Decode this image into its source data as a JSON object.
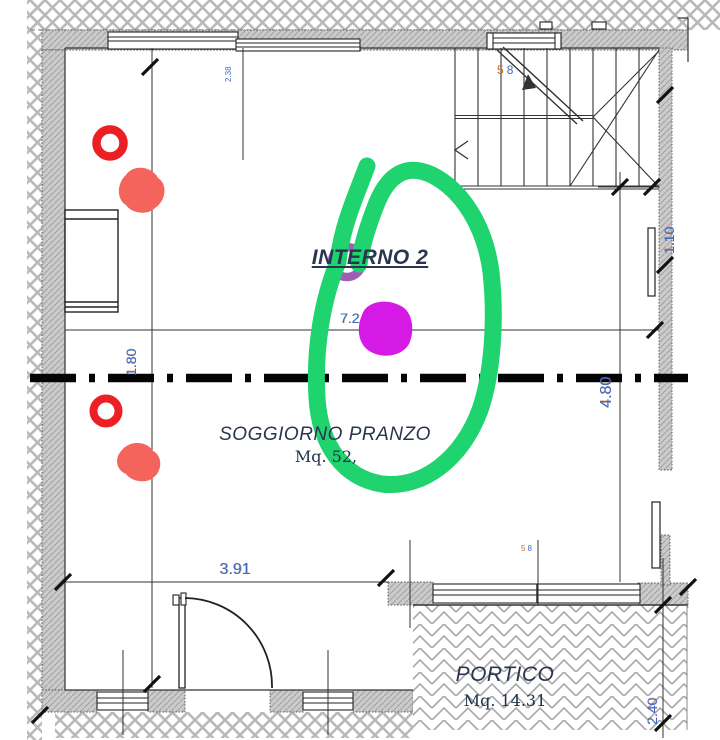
{
  "plan": {
    "labels": {
      "interno": "INTERNO 2",
      "soggiorno": "SOGGIORNO PRANZO",
      "soggiorno_area": "Mq. 52,",
      "portico": "PORTICO",
      "portico_area": "Mq. 14.31"
    },
    "dimensions": {
      "width_bottom": "3.91",
      "width_mid": "7.2",
      "left_segment": "1.80",
      "right_segment": "4.80",
      "stair_side": "1.10",
      "portico_depth": "2.40",
      "small_top": "2.38",
      "small_stair_a": "5",
      "small_stair_b": "8",
      "small_portico_a": "5",
      "small_portico_b": "8"
    },
    "colors": {
      "green_marker": "#1fd36f",
      "magenta_marker": "#d51ae6",
      "purple_marker": "#9040a8",
      "red_marker": "#ec2024",
      "red_blob": "#f4635c",
      "dimension_text": "#3a66c4",
      "label_text": "#2b3550",
      "wall_gray": "#cbcbcb"
    }
  }
}
